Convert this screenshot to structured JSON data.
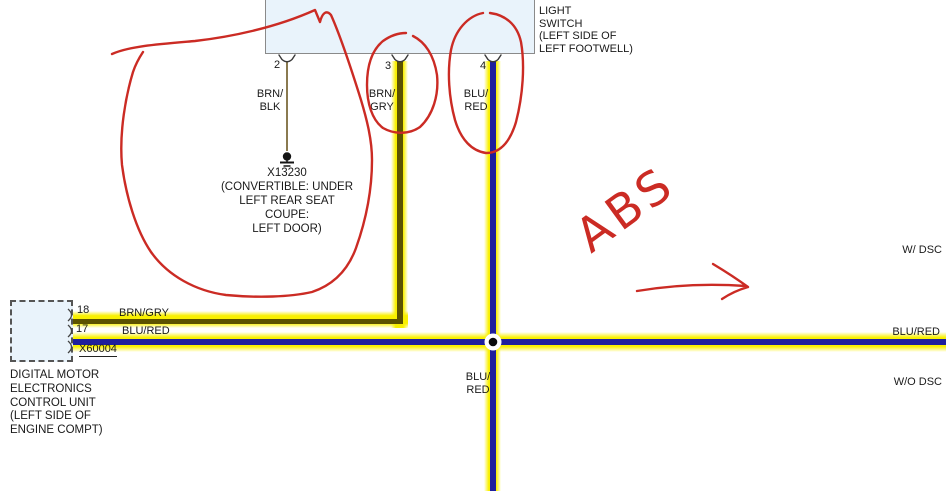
{
  "switch": {
    "title_partial": "BRAKE",
    "title": "LIGHT\nSWITCH\n(LEFT SIDE OF\nLEFT FOOTWELL)",
    "pin2": "2",
    "pin3": "3",
    "pin4": "4",
    "wire2": "BRN/\nBLK",
    "wire3": "BRN/\nGRY",
    "wire4": "BLU/\nRED"
  },
  "ground": {
    "label": "X13230\n(CONVERTIBLE: UNDER\nLEFT REAR SEAT\nCOUPE:\nLEFT DOOR)"
  },
  "dme": {
    "pin18": "18",
    "pin17": "17",
    "connector": "X60004",
    "wire18": "BRN/GRY",
    "wire17": "BLU/RED",
    "name": "DIGITAL MOTOR\nELECTRONICS\nCONTROL UNIT\n(LEFT SIDE OF\nENGINE COMPT)"
  },
  "junction": {
    "label": "BLU/\nRED"
  },
  "right_labels": {
    "with_dsc": "W/ DSC",
    "wire": "BLU/RED",
    "without_dsc": "W/O DSC"
  },
  "annotations": {
    "abs": "ABS"
  },
  "colors": {
    "highlight_yellow": "#f9f000",
    "wire_blue": "#1f1f9c",
    "wire_olive": "#5c5200",
    "wire_tan": "#8a7a50",
    "annotation_red": "#cb2b24",
    "box_fill": "#e9f3fb"
  }
}
